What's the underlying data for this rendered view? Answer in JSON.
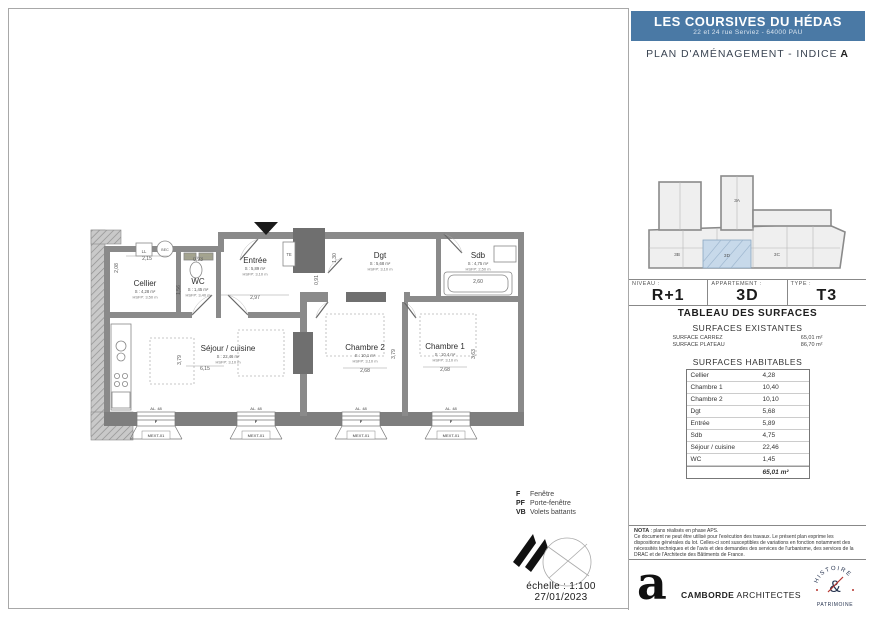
{
  "colors": {
    "banner_blue": "#4a79a5",
    "highlight_blue": "#c7d9ea",
    "stamp_navy": "#26334f",
    "stamp_red": "#b5352f",
    "wall_gray": "#8a8a8a"
  },
  "title_block": {
    "title": "LES COURSIVES DU HÉDAS",
    "address": "22 et 24 rue Serviez - 64000 PAU",
    "plan_title": "PLAN D'AMÉNAGEMENT - INDICE",
    "indice": "A"
  },
  "key_plan": {
    "highlighted_unit": "3D",
    "units": [
      "3A",
      "3B",
      "3D",
      "3C"
    ]
  },
  "info": {
    "niveau_label": "NIVEAU :",
    "niveau": "R+1",
    "appartement_label": "APPARTEMENT :",
    "appartement": "3D",
    "type_label": "TYPE :",
    "type": "T3"
  },
  "surfaces": {
    "table_title": "TABLEAU DES SURFACES",
    "existantes_title": "SURFACES EXISTANTES",
    "carrez_label": "SURFACE CARREZ",
    "carrez_value": "65,01 m²",
    "plateau_label": "SURFACE PLATEAU",
    "plateau_value": "86,70 m²",
    "habitables_title": "SURFACES HABITABLES",
    "rows": [
      {
        "label": "Cellier",
        "value": "4,28"
      },
      {
        "label": "Chambre 1",
        "value": "10,40"
      },
      {
        "label": "Chambre 2",
        "value": "10,10"
      },
      {
        "label": "Dgt",
        "value": "5,68"
      },
      {
        "label": "Entrée",
        "value": "5,89"
      },
      {
        "label": "Sdb",
        "value": "4,75"
      },
      {
        "label": "Séjour / cuisine",
        "value": "22,46"
      },
      {
        "label": "WC",
        "value": "1,45"
      }
    ],
    "total": "65,01 m²"
  },
  "nota": {
    "heading": "NOTA",
    "line1": " : plans réalisés en phase APS.",
    "body": "Ce document ne peut être utilisé pour l'exécution des travaux. Le présent plan exprime les dispositions générales du lot. Celles-ci sont susceptibles de variations en fonction notamment des nécessités techniques et de l'avis et des demandes des services de l'urbanisme, des services de la DRAC et de l'Architecte des Bâtiments de France."
  },
  "footer": {
    "logo_letter": "a",
    "architect_bold": "CAMBORDE",
    "architect_regular": " ARCHITECTES",
    "stamp_top": "HISTOIRE",
    "stamp_mid": "&",
    "stamp_bottom": "PATRIMOINE"
  },
  "legend": {
    "items": [
      {
        "key": "F",
        "label": "Fenêtre"
      },
      {
        "key": "PF",
        "label": "Porte-fenêtre"
      },
      {
        "key": "VB",
        "label": "Volets battants"
      }
    ]
  },
  "scale": {
    "text": "échelle : 1:100",
    "date": "27/01/2023"
  },
  "plan": {
    "rooms": [
      {
        "name": "Cellier",
        "area": "S : 4,28 m²",
        "height": "HSFP: 3,50 m"
      },
      {
        "name": "WC",
        "area": "S : 1,45 m²",
        "height": "HSFP: 3,40 m"
      },
      {
        "name": "Entrée",
        "area": "S : 5,89 m²",
        "height": "HSFP: 3,10 m"
      },
      {
        "name": "Dgt",
        "area": "S : 5,68 m²",
        "height": "HSFP: 3,10 m"
      },
      {
        "name": "Sdb",
        "area": "S : 4,75 m²",
        "height": "HSFP: 2,50 m"
      },
      {
        "name": "Séjour / cuisine",
        "area": "S : 22,46 m²",
        "height": "HSFP: 3,10 m"
      },
      {
        "name": "Chambre 2",
        "area": "S : 10,1 m²",
        "height": "HSFP: 3,10 m"
      },
      {
        "name": "Chambre 1",
        "area": "S : 10,4 m²",
        "height": "HSFP: 3,10 m"
      }
    ],
    "dims": [
      "2,15",
      "0,93",
      "2,08",
      "1,56",
      "2,97",
      "0,91",
      "1,30",
      "2,60",
      "6,15",
      "3,79",
      "2,68",
      "3,79",
      "2,68",
      "3,63"
    ],
    "labels": {
      "ll": "LL",
      "bec": "BEC",
      "te": "TE"
    },
    "window": {
      "f": "F",
      "tag": "MEXT-01",
      "sill": "AL. 48"
    }
  }
}
